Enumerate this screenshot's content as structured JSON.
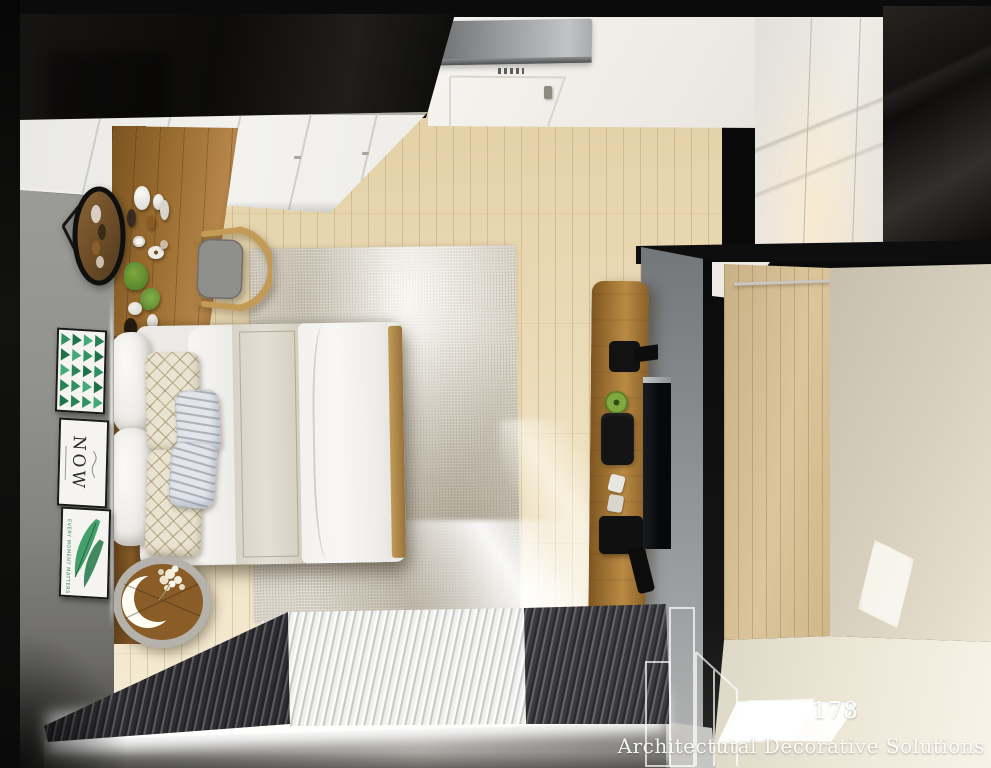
{
  "watermark": {
    "number": "178",
    "brand": "Architectutal Decorative Solutions"
  },
  "wall_art": {
    "now": "NOW",
    "leaf_caption": "EVERY MOMENT MATTERS"
  },
  "palette": {
    "ceiling_black": "#0d0d0d",
    "closet_white": "#f0efec",
    "wall_gray": "#95948f",
    "floor_wood": "#ecdcb8",
    "furniture_wood": "#9c6c30",
    "rug_beige": "#d7d2c5",
    "bed_white": "#f4f3f1",
    "art_green": "#2e8b57",
    "curtain_dark": "#39393c",
    "curtain_light": "#f2f2f0",
    "partition_gray": "#8b8f92",
    "hall_wall_beige": "#d8d1c1",
    "tv_black": "#101214",
    "watermark_white": "#ffffff"
  }
}
